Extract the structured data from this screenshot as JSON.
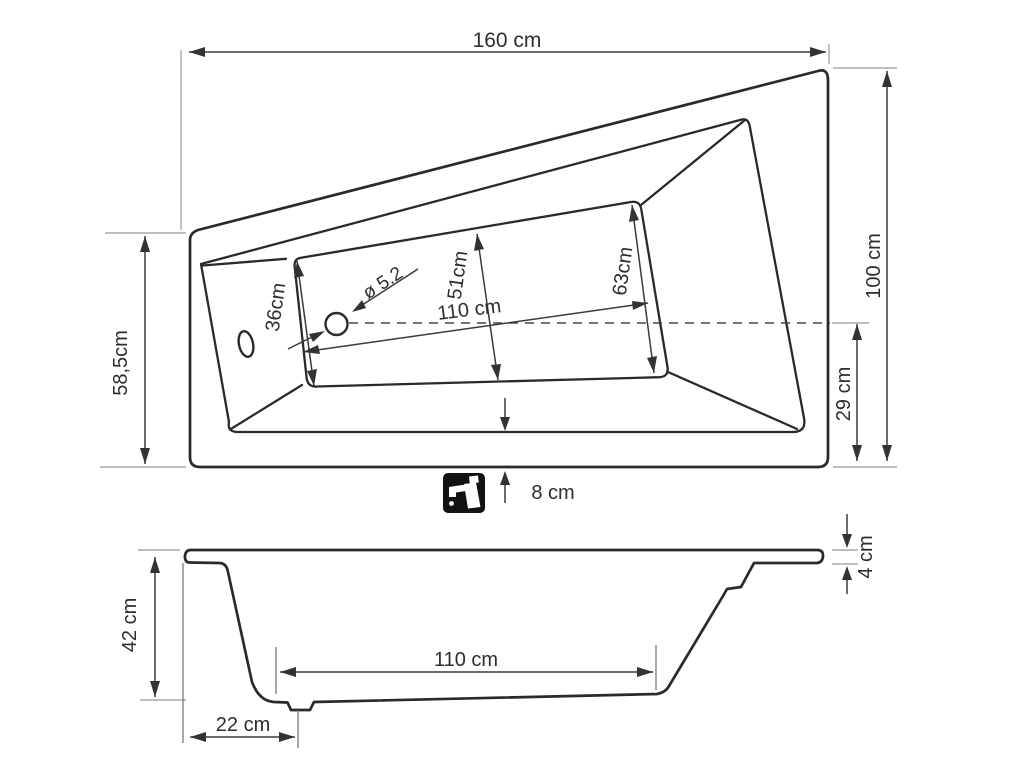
{
  "drawing": {
    "type": "bathtub-technical-drawing",
    "views": [
      "top-view",
      "side-view"
    ]
  },
  "top_view": {
    "overall_width": "160 cm",
    "left_height": "58,5cm",
    "right_height": "100 cm",
    "right_partial_height": "29 cm",
    "basin_width_left": "36cm",
    "basin_width_middle": "51cm",
    "basin_width_right": "63cm",
    "basin_length": "110 cm",
    "drain_diameter": "ø 5.2",
    "apron_width": "8 cm",
    "faucet_icon": "faucet"
  },
  "side_view": {
    "height": "42 cm",
    "rim_thickness": "4 cm",
    "bottom_length": "110 cm",
    "drain_offset": "22 cm"
  },
  "colors": {
    "background": "#ffffff",
    "contour_line": "#2a2a2a",
    "dimension_line": "#3a3a3a",
    "extension_line": "#a9a9a9",
    "icon_background": "#121212",
    "icon_glyph": "#ffffff"
  }
}
